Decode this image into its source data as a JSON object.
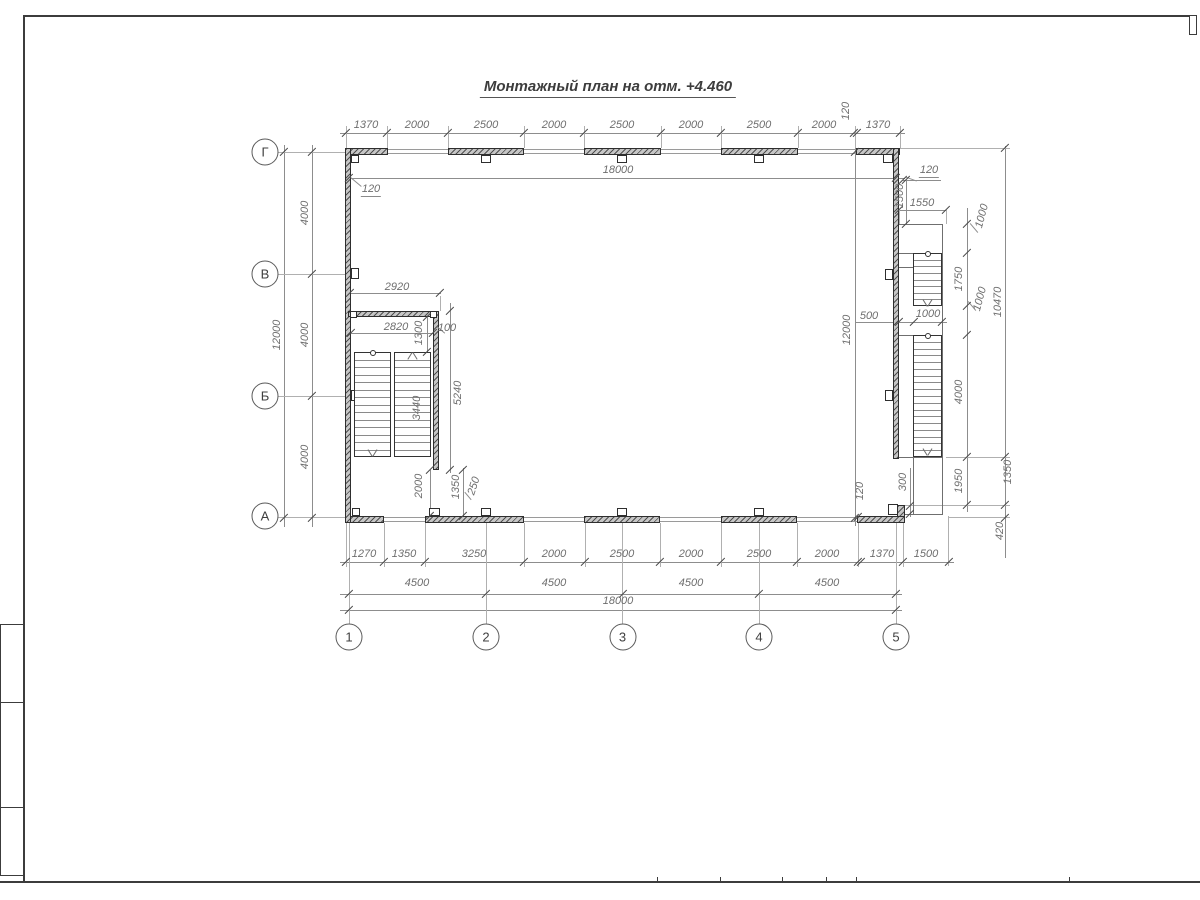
{
  "title": "Монтажный план на отм. +4.460",
  "axes": {
    "columns": [
      "1",
      "2",
      "3",
      "4",
      "5"
    ],
    "rows": [
      "Г",
      "В",
      "Б",
      "А"
    ]
  },
  "dim_labels": [
    {
      "t": "1370",
      "x": 366,
      "y": 125,
      "r": 0
    },
    {
      "t": "2000",
      "x": 417,
      "y": 125,
      "r": 0
    },
    {
      "t": "2500",
      "x": 486,
      "y": 125,
      "r": 0
    },
    {
      "t": "2000",
      "x": 554,
      "y": 125,
      "r": 0
    },
    {
      "t": "2500",
      "x": 622,
      "y": 125,
      "r": 0
    },
    {
      "t": "2000",
      "x": 691,
      "y": 125,
      "r": 0
    },
    {
      "t": "2500",
      "x": 759,
      "y": 125,
      "r": 0
    },
    {
      "t": "2000",
      "x": 824,
      "y": 125,
      "r": 0
    },
    {
      "t": "120",
      "x": 846,
      "y": 111,
      "r": -90
    },
    {
      "t": "1370",
      "x": 878,
      "y": 125,
      "r": 0
    },
    {
      "t": "18000",
      "x": 618,
      "y": 170,
      "r": 0
    },
    {
      "t": "120",
      "x": 371,
      "y": 190,
      "r": 0,
      "u": 1
    },
    {
      "t": "120",
      "x": 929,
      "y": 171,
      "r": 0,
      "u": 1
    },
    {
      "t": "1500",
      "x": 900,
      "y": 196,
      "r": -90
    },
    {
      "t": "1550",
      "x": 922,
      "y": 203,
      "r": 0
    },
    {
      "t": "1000",
      "x": 928,
      "y": 314,
      "r": 0
    },
    {
      "t": "500",
      "x": 869,
      "y": 316,
      "r": 0
    },
    {
      "t": "12000",
      "x": 847,
      "y": 330,
      "r": -90
    },
    {
      "t": "12000",
      "x": 277,
      "y": 335,
      "r": -90
    },
    {
      "t": "4000",
      "x": 305,
      "y": 213,
      "r": -90
    },
    {
      "t": "4000",
      "x": 305,
      "y": 335,
      "r": -90
    },
    {
      "t": "4000",
      "x": 305,
      "y": 457,
      "r": -90
    },
    {
      "t": "1000",
      "x": 982,
      "y": 216,
      "r": -75
    },
    {
      "t": "1750",
      "x": 959,
      "y": 279,
      "r": -90
    },
    {
      "t": "1000",
      "x": 980,
      "y": 299,
      "r": -75
    },
    {
      "t": "4000",
      "x": 959,
      "y": 392,
      "r": -90
    },
    {
      "t": "1950",
      "x": 959,
      "y": 481,
      "r": -90
    },
    {
      "t": "10470",
      "x": 998,
      "y": 302,
      "r": -90
    },
    {
      "t": "1350",
      "x": 1008,
      "y": 472,
      "r": -90
    },
    {
      "t": "420",
      "x": 1000,
      "y": 531,
      "r": -90
    },
    {
      "t": "300",
      "x": 903,
      "y": 482,
      "r": -90
    },
    {
      "t": "120",
      "x": 860,
      "y": 491,
      "r": -90
    },
    {
      "t": "2920",
      "x": 397,
      "y": 287,
      "r": 0
    },
    {
      "t": "2820",
      "x": 396,
      "y": 327,
      "r": 0
    },
    {
      "t": "1300",
      "x": 419,
      "y": 333,
      "r": -90
    },
    {
      "t": "100",
      "x": 447,
      "y": 328,
      "r": 0
    },
    {
      "t": "3440",
      "x": 417,
      "y": 408,
      "r": -90
    },
    {
      "t": "5240",
      "x": 458,
      "y": 393,
      "r": -90
    },
    {
      "t": "2000",
      "x": 419,
      "y": 486,
      "r": -90
    },
    {
      "t": "1350",
      "x": 456,
      "y": 487,
      "r": -90
    },
    {
      "t": "250",
      "x": 474,
      "y": 486,
      "r": -72
    },
    {
      "t": "1270",
      "x": 364,
      "y": 554,
      "r": 0
    },
    {
      "t": "1350",
      "x": 404,
      "y": 554,
      "r": 0
    },
    {
      "t": "3250",
      "x": 474,
      "y": 554,
      "r": 0
    },
    {
      "t": "2000",
      "x": 554,
      "y": 554,
      "r": 0
    },
    {
      "t": "2500",
      "x": 622,
      "y": 554,
      "r": 0
    },
    {
      "t": "2000",
      "x": 691,
      "y": 554,
      "r": 0
    },
    {
      "t": "2500",
      "x": 759,
      "y": 554,
      "r": 0
    },
    {
      "t": "2000",
      "x": 827,
      "y": 554,
      "r": 0
    },
    {
      "t": "1370",
      "x": 882,
      "y": 554,
      "r": 0
    },
    {
      "t": "1500",
      "x": 926,
      "y": 554,
      "r": 0
    },
    {
      "t": "4500",
      "x": 417,
      "y": 583,
      "r": 0
    },
    {
      "t": "4500",
      "x": 554,
      "y": 583,
      "r": 0
    },
    {
      "t": "4500",
      "x": 691,
      "y": 583,
      "r": 0
    },
    {
      "t": "4500",
      "x": 827,
      "y": 583,
      "r": 0
    },
    {
      "t": "18000",
      "x": 618,
      "y": 601,
      "r": 0
    }
  ]
}
